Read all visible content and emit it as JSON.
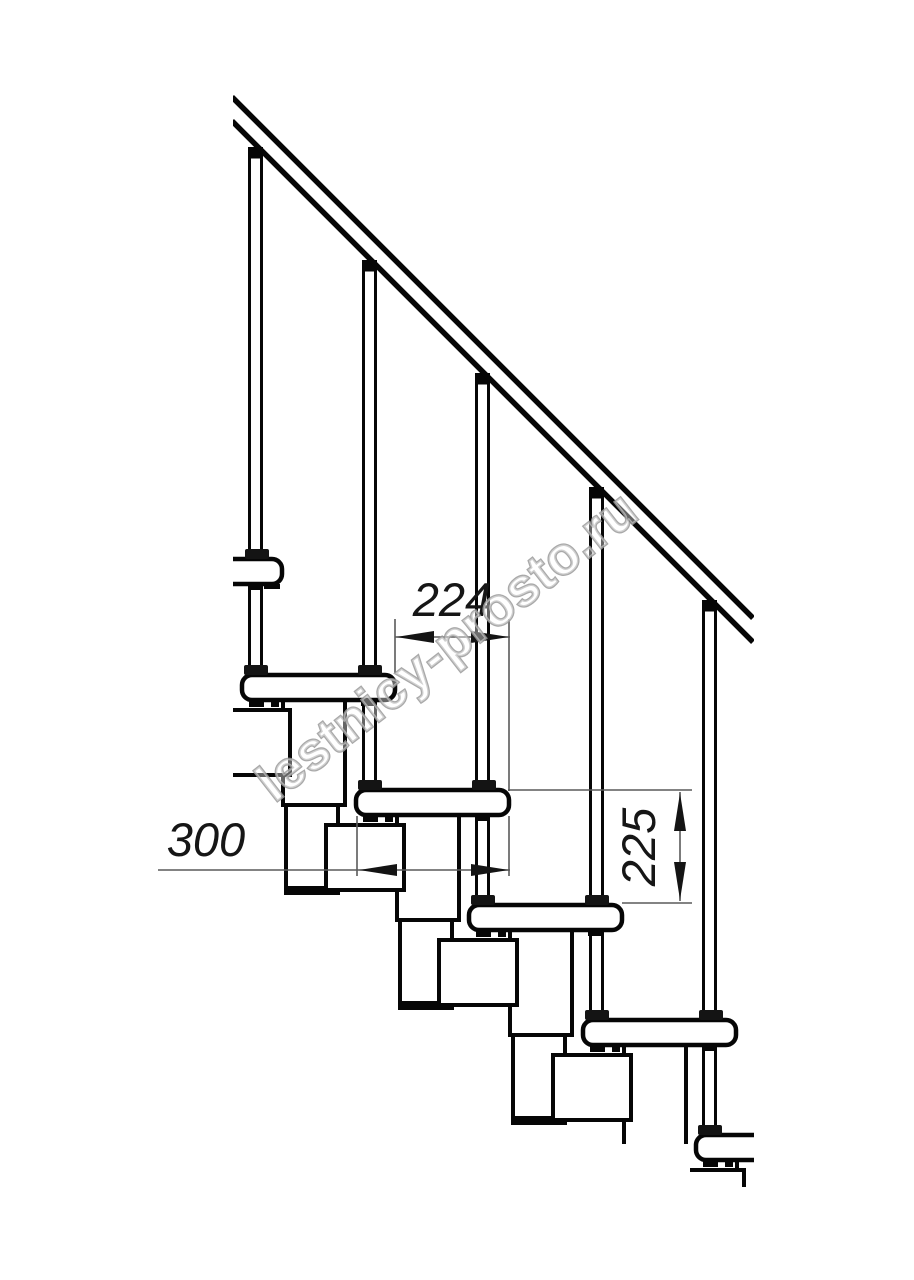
{
  "page": {
    "background_color": "#ffffff"
  },
  "drawing": {
    "kind": "staircase side-view technical drawing",
    "line_color": "#060606",
    "dimension_line_color": "#5a5a5a",
    "dimensions": {
      "step_run": {
        "value": "224"
      },
      "tread_depth": {
        "value": "300"
      },
      "step_rise": {
        "value": "225"
      }
    },
    "watermark": {
      "text": "lestnicy-prosto.ru",
      "color": "#9b9b9b"
    }
  }
}
